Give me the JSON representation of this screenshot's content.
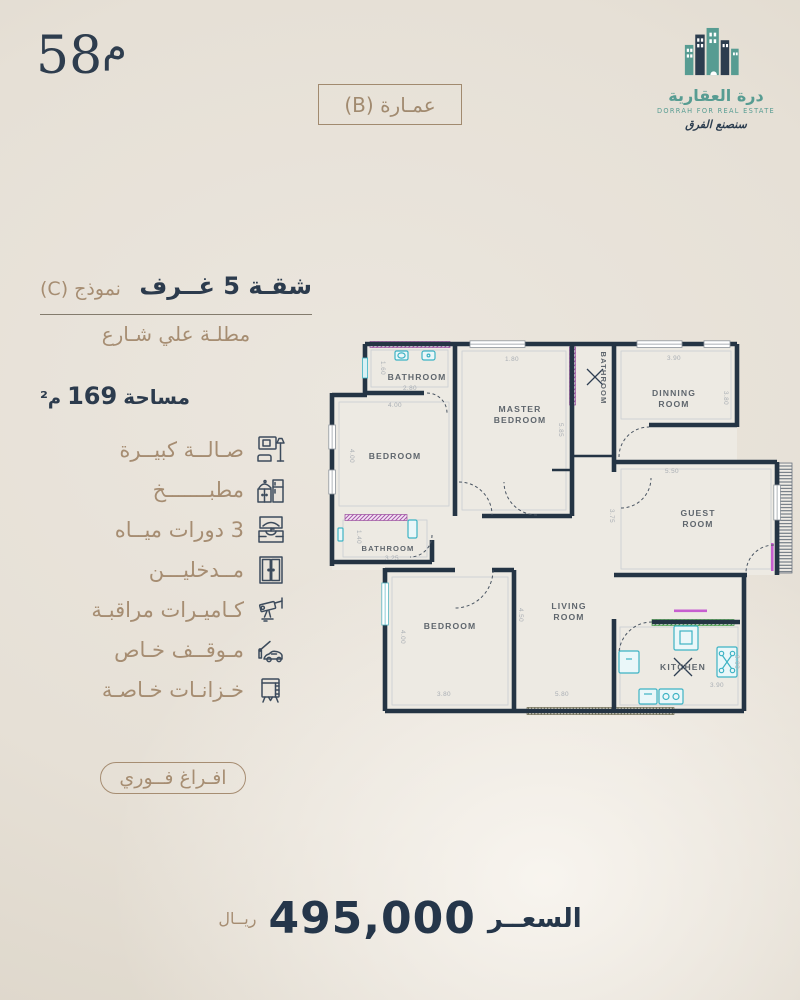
{
  "header": {
    "unit_number": "58",
    "unit_suffix": "م",
    "building_label": "عمـارة (B)"
  },
  "logo": {
    "arabic_name": "درة العقارية",
    "english_name": "DORRAH FOR REAL ESTATE",
    "tagline": "سنصنع الفرق",
    "teal": "#579c92",
    "navy": "#2c3d4f"
  },
  "listing": {
    "title": "شقـة 5 غــرف",
    "model": "نموذج (C)",
    "subtitle": "مطلـة علي شـارع",
    "area_label": "مساحة",
    "area_value": "169",
    "area_unit": "م²"
  },
  "features": [
    {
      "label": "صـالــة كبيــرة",
      "icon": "living-room-icon"
    },
    {
      "label": "مطبـــــــخ",
      "icon": "kitchen-icon"
    },
    {
      "label": "3 دورات ميــاه",
      "icon": "bathroom-vanity-icon"
    },
    {
      "label": "مــدخليـــن",
      "icon": "double-door-icon"
    },
    {
      "label": "كـاميـرات مراقبـة",
      "icon": "cctv-camera-icon"
    },
    {
      "label": "مـوقــف خـاص",
      "icon": "car-parking-icon"
    },
    {
      "label": "خـزانـات خـاصـة",
      "icon": "water-tank-icon"
    }
  ],
  "availability": "افـراغ فــوري",
  "price": {
    "label": "السعــر",
    "value": "495,000",
    "currency": "ريــال"
  },
  "floorplan": {
    "labels": {
      "bathroom_top": "BATHROOM",
      "master1": "MASTER",
      "master2": "BEDROOM",
      "dining1": "DINNING",
      "dining2": "ROOM",
      "bedroom_left": "BEDROOM",
      "bathroom_mid": "BATHROOM",
      "guest1": "GUEST",
      "guest2": "ROOM",
      "bathroom_lower": "BATHROOM",
      "bedroom_bottom": "BEDROOM",
      "living1": "LIVING",
      "living2": "ROOM",
      "kitchen": "KITCHEN"
    },
    "dims": {
      "d160": "1.60",
      "d280": "2.80",
      "d400a": "4.00",
      "d180": "1.80",
      "d585": "5.85",
      "d390a": "3.90",
      "d380a": "3.80",
      "d550": "5.50",
      "d375": "3.75",
      "d140": "1.40",
      "d325": "3.25",
      "d400b": "4.00",
      "d380b": "3.80",
      "d450": "4.50",
      "d580": "5.80",
      "d300": "3.00",
      "d390b": "3.90"
    },
    "colors": {
      "wall": "#243444",
      "fixture": "#3db3c4",
      "hatch_pink": "#a855ad",
      "hatch_green": "#3f9b42"
    }
  }
}
